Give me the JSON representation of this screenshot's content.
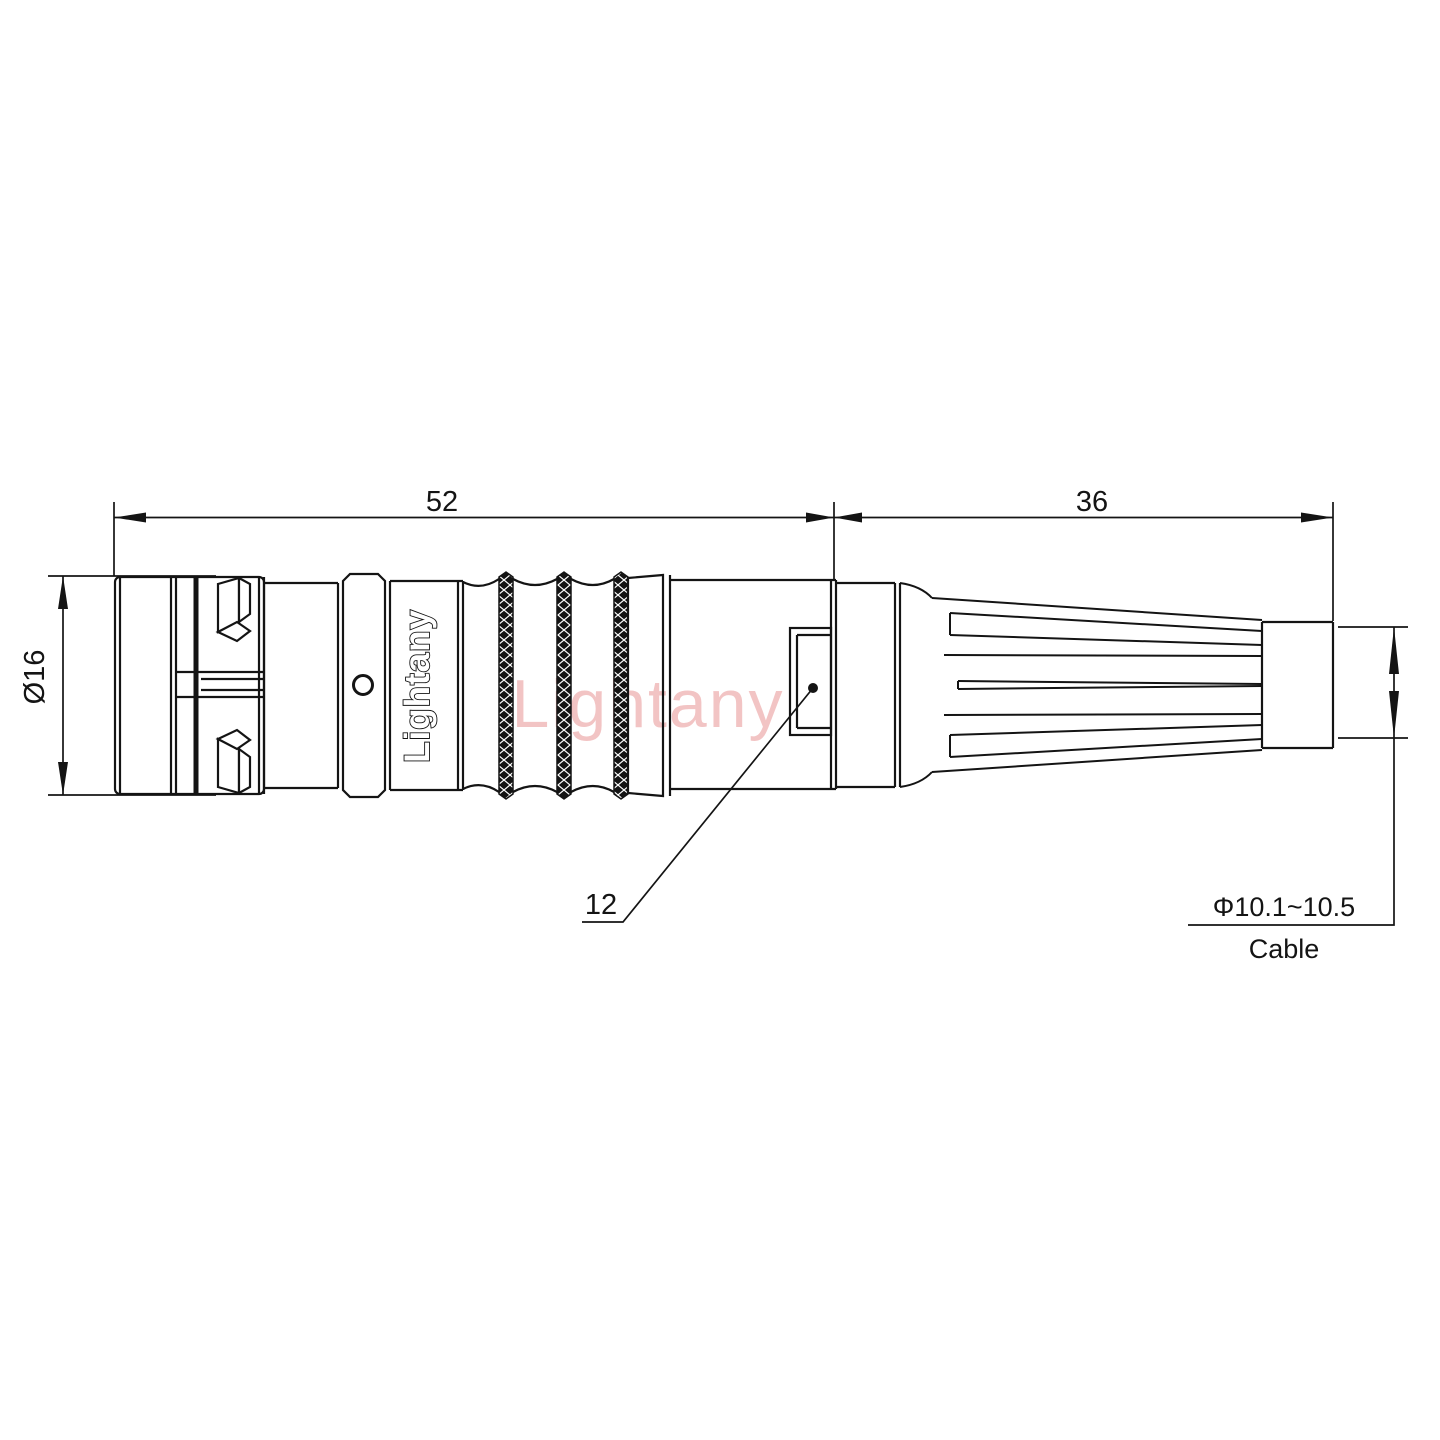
{
  "drawing_title": "circular-push-pull-connector-outline-drawing",
  "brand": {
    "body_label": "Lightany",
    "watermark": "Lightany"
  },
  "dimensions": {
    "front_length": "52",
    "rear_length": "36",
    "front_diameter": "Ø16",
    "nut_size": "12",
    "cable_diameter": "Φ10.1~10.5",
    "cable_label": "Cable"
  },
  "colors": {
    "line": "#141414",
    "dimension_line": "#141414",
    "watermark": "#e78b8b",
    "background": "#ffffff"
  }
}
